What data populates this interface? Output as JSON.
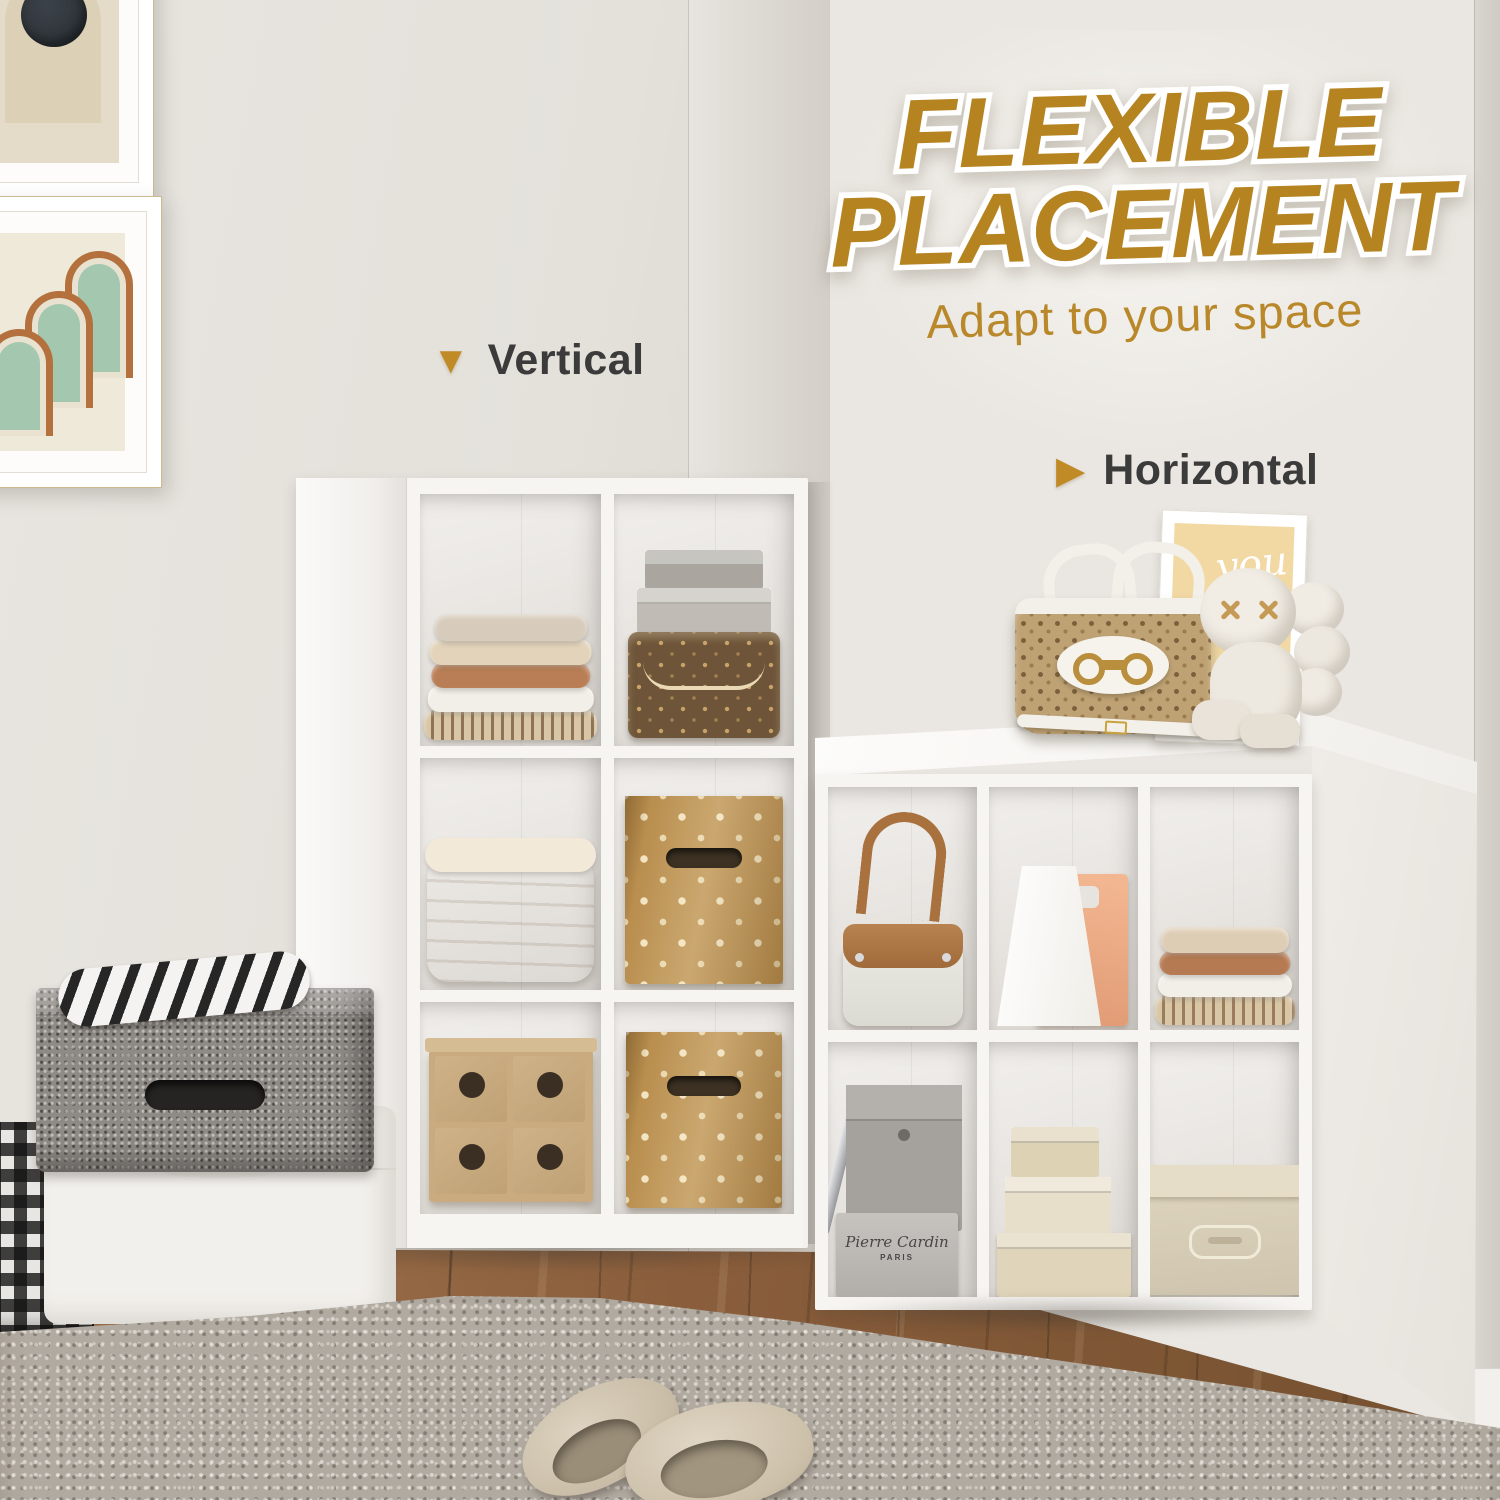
{
  "header": {
    "title_line1": "FLEXIBLE",
    "title_line2": "PLACEMENT",
    "subtitle": "Adapt to your space"
  },
  "annotations": {
    "vertical": {
      "label": "Vertical",
      "icon": "triangle-down-icon",
      "glyph": "▼"
    },
    "horizontal": {
      "label": "Horizontal",
      "icon": "triangle-right-icon",
      "glyph": "▶"
    }
  },
  "props": {
    "frame_script_line1": "you",
    "frame_script_line2": "shine",
    "box_brand_script": "Pierre Cardin",
    "box_brand_sub": "PARIS"
  },
  "palette": {
    "accent_gold": "#b5831f",
    "subtitle_gold": "#b9882a",
    "label_dark": "#3b3b3b",
    "wall": "#e9e6e1",
    "shelf_white": "#f7f5f2",
    "wood_floor": "#8a5e3c",
    "rug_gray": "#b1aaa0",
    "polka_bin_gold": "#b98e4e",
    "monogram_brown": "#6e5539"
  }
}
